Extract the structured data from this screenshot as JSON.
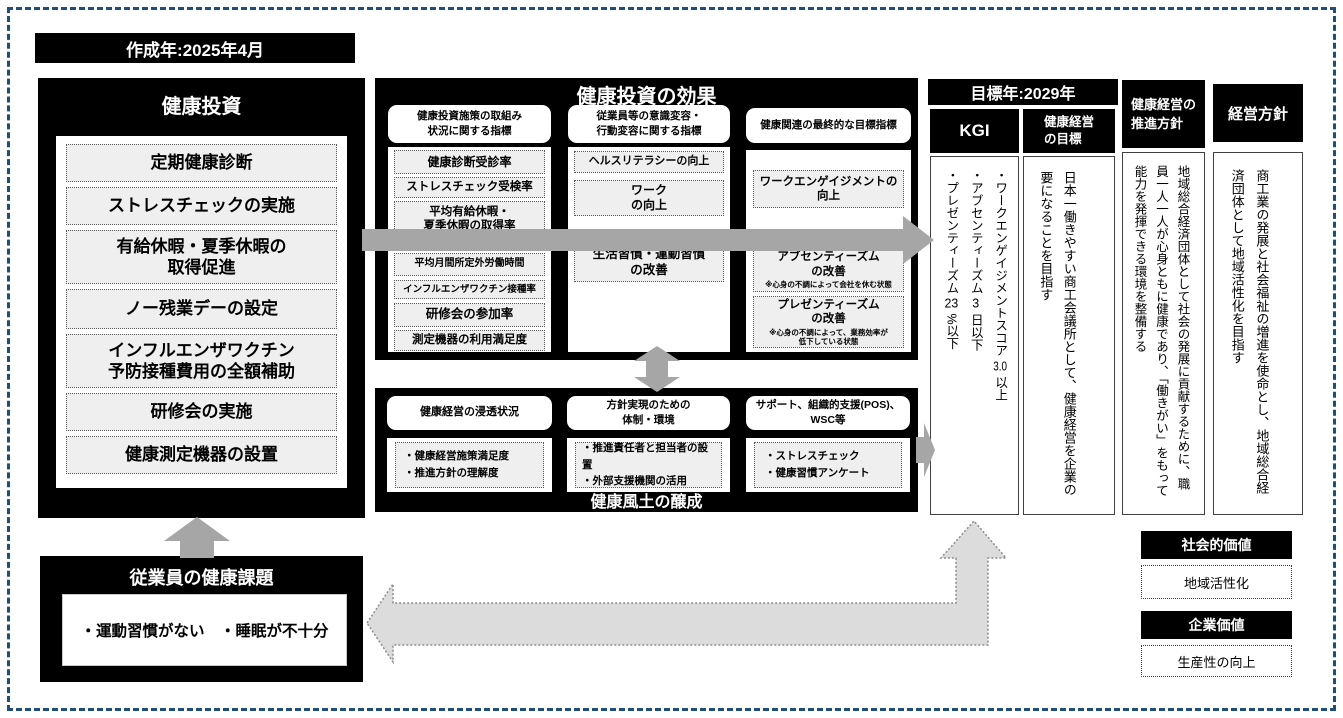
{
  "meta": {
    "created_year": "作成年:2025年4月",
    "target_year": "目標年:2029年",
    "artifact": "100"
  },
  "invest": {
    "title": "健康投資",
    "items": [
      "定期健康診断",
      "ストレスチェックの実施",
      "有給休暇・夏季休暇の\n取得促進",
      "ノー残業デーの設定",
      "インフルエンザワクチン\n予防接種費用の全額補助",
      "研修会の実施",
      "健康測定機器の設置"
    ]
  },
  "effect": {
    "title": "健康投資の効果",
    "col1": {
      "header": "健康投資施策の取組み\n状況に関する指標",
      "items": [
        "健康診断受診率",
        "ストレスチェック受検率",
        "平均有給休暇・\n夏季休暇の取得率",
        "平均月間所定外労働時間",
        "インフルエンザワクチン接種率",
        "研修会の参加率",
        "測定機器の利用満足度"
      ]
    },
    "col2": {
      "header": "従業員等の意識変容・\n行動変容に関する指標",
      "items": [
        "ヘルスリテラシーの向上",
        "ワーク\nの向上",
        "生活習慣・運動習慣\nの改善"
      ]
    },
    "col3": {
      "header": "健康関連の最終的な目標指標",
      "items": [
        {
          "label": "ワークエンゲイジメントの\n向上",
          "note": ""
        },
        {
          "label": "アブセンティーズム\nの改善",
          "note": "※心身の不調によって会社を休む状態"
        },
        {
          "label": "プレゼンティーズム\nの改善",
          "note": "※心身の不調によって、業務効率が\n低下している状態"
        }
      ]
    }
  },
  "culture": {
    "title": "健康風土の醸成",
    "col1": {
      "header": "健康経営の浸透状況",
      "body": "・健康経営施策満足度\n・推進方針の理解度"
    },
    "col2": {
      "header": "方針実現のための\n体制・環境",
      "body": "・推進責任者と担当者の設置\n・外部支援機関の活用"
    },
    "col3": {
      "header": "サポート、組織的支援(POS)、\nWSC等",
      "body": "・ストレスチェック\n・健康習慣アンケート"
    }
  },
  "kgi": {
    "header": "KGI",
    "items": [
      {
        "pre": "・ワークエンゲイジメントスコア ",
        "num": "3.0",
        "post": " 以上"
      },
      {
        "pre": "・アブセンティーズム ",
        "num": "3",
        "post": " 日以下"
      },
      {
        "pre": "・プレゼンティーズム ",
        "num": "23",
        "post": " %以下"
      }
    ]
  },
  "goal": {
    "header": "健康経営\nの目標",
    "body": "日本一働きやすい商工会議所として、健康経営を企業の要になることを目指す"
  },
  "policy": {
    "header": "健康経営の\n推進方針",
    "body": "地域総合経済団体として社会の発展に貢献するために、職員一人一人が心身ともに健康であり、「働きがい」をもって能力を発揮できる環境を整備する"
  },
  "management": {
    "header": "経営方針",
    "body": "商工業の発展と社会福祉の増進を使命とし、地域総合経済団体として地域活性化を目指す"
  },
  "issues": {
    "title": "従業員の健康課題",
    "body": "・運動習慣がない　・睡眠が不十分"
  },
  "values": {
    "social": {
      "header": "社会的価値",
      "item": "地域活性化"
    },
    "corporate": {
      "header": "企業価値",
      "item": "生産性の向上"
    }
  },
  "colors": {
    "frame_border": "#1f4e79",
    "solid_arrow": "#a6a6a6",
    "light_arrow": "#dcdcdc",
    "box_black": "#000000",
    "item_bg": "#efefef"
  }
}
